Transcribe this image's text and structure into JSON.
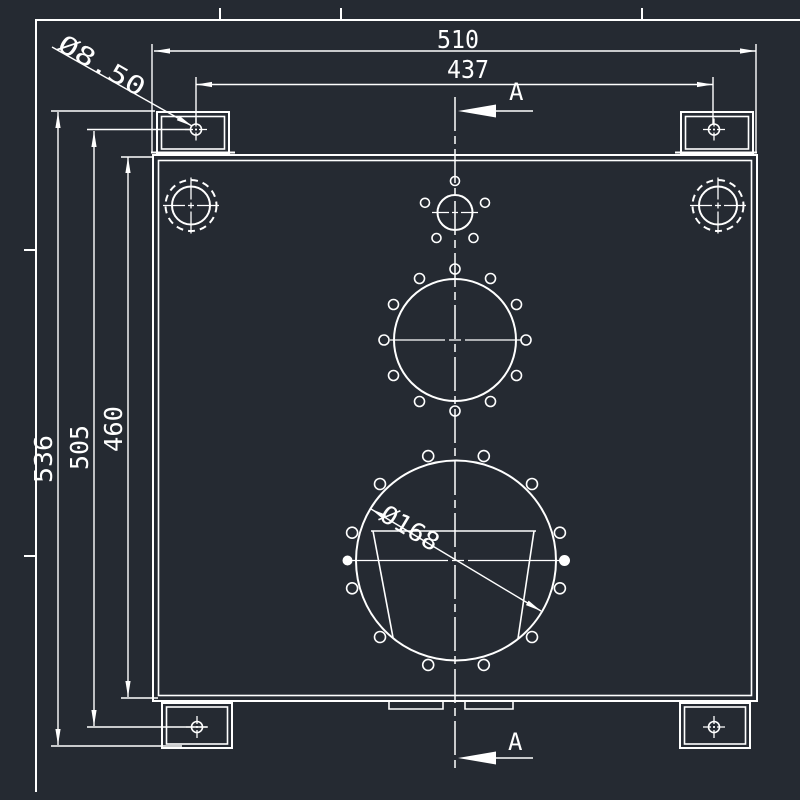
{
  "canvas": {
    "background": "#252a32",
    "line_color": "#ffffff"
  },
  "drawing": {
    "dimensions": {
      "overall_width": "510",
      "mount_hole_span_width": "437",
      "overall_height": "536",
      "mount_hole_span_height": "505",
      "body_height": "460",
      "mount_hole_diameter": "Ø8.50",
      "large_port_diameter": "Ø168"
    },
    "section": {
      "top_label": "A",
      "bottom_label": "A"
    }
  }
}
